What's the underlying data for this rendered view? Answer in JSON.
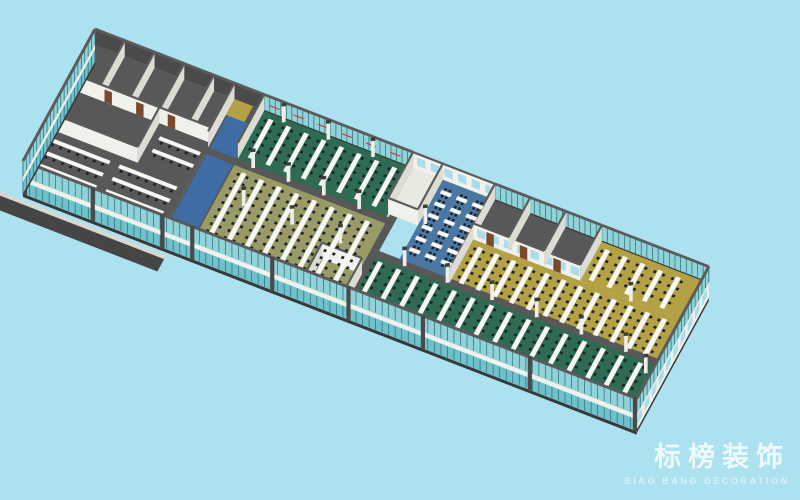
{
  "watermark": {
    "title": "标榜装饰",
    "subtitle": "BIAO BANG DECORATION"
  },
  "colors": {
    "background": "#ace1f0",
    "wall_dark": "#4a4a4a",
    "wall_base": "#383838",
    "wall_cap": "#5b5b5b",
    "wall_white": "#f1f1ec",
    "wall_white_shade": "#dcdcd4",
    "white_floor": "#e9e9e2",
    "glass": "#8fd2d8",
    "glass_dark": "#6fc2cc",
    "mullion": "#2f6e78",
    "window_glass": "#aadcec",
    "floor_dark": "#585858",
    "floor_olive": "#9a9a66",
    "floor_green": "#2e6b52",
    "floor_blue": "#4a78a2",
    "floor_yellow": "#b3a144",
    "carpet_blue": "#3e6da5",
    "desk": "#f6f6f3",
    "chair": "#1a2430",
    "column": "#eeeee8",
    "column_cap": "#3c3c3c",
    "door": "#7b4a2d",
    "signage": "#cc4444",
    "ramp": "#454545",
    "ramp_stripe": "#d8d8d2"
  },
  "scene": {
    "matrix": [
      0.93,
      0.36,
      -0.48,
      0.88,
      95,
      45
    ],
    "story_down": [
      7.75,
      15
    ],
    "ramp": [
      {
        "x": -28,
        "y": 156,
        "w": 185,
        "h": 4,
        "o": 1.05,
        "c": "ramp_stripe",
        "n": "entry-ramp-curb"
      },
      {
        "x": -28,
        "y": 160,
        "w": 185,
        "h": 14,
        "o": 1.05,
        "c": "ramp",
        "n": "entry-ramp"
      }
    ],
    "floors": [
      {
        "n": "meeting-block-floor",
        "x": 0,
        "y": 0,
        "w": 150,
        "h": 150,
        "c": "floor_dark"
      },
      {
        "n": "lobby-floor",
        "x": 150,
        "y": 0,
        "w": 32,
        "h": 150,
        "c": "floor_dark"
      },
      {
        "n": "lobby-carpet",
        "x": 152,
        "y": 18,
        "w": 28,
        "h": 130,
        "c": "carpet_blue"
      },
      {
        "n": "lobby-mat",
        "x": 150,
        "y": 0,
        "w": 20,
        "h": 18,
        "c": "floor_yellow"
      },
      {
        "n": "green-office-back-floor",
        "x": 182,
        "y": 0,
        "w": 160,
        "h": 58,
        "c": "floor_green"
      },
      {
        "n": "olive-office-floor",
        "x": 182,
        "y": 58,
        "w": 168,
        "h": 92,
        "c": "floor_olive"
      },
      {
        "n": "white-room-floor",
        "x": 342,
        "y": 0,
        "w": 32,
        "h": 52,
        "c": "white_floor"
      },
      {
        "n": "pod-zone-floor",
        "x": 374,
        "y": 0,
        "w": 56,
        "h": 95,
        "c": "floor_blue"
      },
      {
        "n": "back-rooms-floor",
        "x": 430,
        "y": 0,
        "w": 115,
        "h": 45,
        "c": "floor_dark"
      },
      {
        "n": "yellow-office-back-floor",
        "x": 545,
        "y": 0,
        "w": 115,
        "h": 45,
        "c": "floor_yellow"
      },
      {
        "n": "yellow-office-floor",
        "x": 430,
        "y": 45,
        "w": 230,
        "h": 50,
        "c": "floor_yellow"
      },
      {
        "n": "green-office-front-floor",
        "x": 350,
        "y": 95,
        "w": 310,
        "h": 55,
        "c": "floor_green"
      },
      {
        "n": "corridor-mid",
        "x": 150,
        "y": 55,
        "w": 200,
        "h": 7,
        "c": "floor_dark"
      },
      {
        "n": "corridor-right",
        "x": 350,
        "y": 90,
        "w": 310,
        "h": 7,
        "c": "floor_dark"
      },
      {
        "n": "corridor-vertical",
        "x": 344,
        "y": 52,
        "w": 8,
        "h": 98,
        "c": "floor_dark"
      }
    ],
    "walls_dark": [
      {
        "x1": 0,
        "y1": 0,
        "x2": 182,
        "y2": 0
      }
    ],
    "glass_back": [
      {
        "x1": 182,
        "y1": 0,
        "x2": 342,
        "y2": 0,
        "signage": true
      },
      {
        "x1": 430,
        "y1": 0,
        "x2": 660,
        "y2": 0
      }
    ],
    "walls_white": [
      {
        "x1": 32,
        "y1": 0,
        "x2": 32,
        "y2": 50
      },
      {
        "x1": 64,
        "y1": 0,
        "x2": 64,
        "y2": 50
      },
      {
        "x1": 96,
        "y1": 0,
        "x2": 96,
        "y2": 50
      },
      {
        "x1": 128,
        "y1": 0,
        "x2": 128,
        "y2": 50
      },
      {
        "x1": 0,
        "y1": 50,
        "x2": 150,
        "y2": 50,
        "doors": [
          40,
          74,
          108
        ]
      },
      {
        "x1": 95,
        "y1": 50,
        "x2": 95,
        "y2": 95
      },
      {
        "x1": 0,
        "y1": 95,
        "x2": 95,
        "y2": 95
      },
      {
        "x1": 150,
        "y1": 0,
        "x2": 150,
        "y2": 55
      },
      {
        "x1": 182,
        "y1": 0,
        "x2": 182,
        "y2": 55
      },
      {
        "x1": 342,
        "y1": 0,
        "x2": 430,
        "y2": 0,
        "windows": true
      },
      {
        "x1": 342,
        "y1": 0,
        "x2": 342,
        "y2": 52
      },
      {
        "x1": 374,
        "y1": 0,
        "x2": 374,
        "y2": 52
      },
      {
        "x1": 342,
        "y1": 52,
        "x2": 374,
        "y2": 52
      },
      {
        "x1": 430,
        "y1": 0,
        "x2": 430,
        "y2": 95
      },
      {
        "x1": 430,
        "y1": 45,
        "x2": 545,
        "y2": 45,
        "doors": [
          448,
          484,
          520
        ],
        "windows": true
      },
      {
        "x1": 468,
        "y1": 0,
        "x2": 468,
        "y2": 45
      },
      {
        "x1": 506,
        "y1": 0,
        "x2": 506,
        "y2": 45
      },
      {
        "x1": 545,
        "y1": 0,
        "x2": 545,
        "y2": 45
      },
      {
        "x1": 305,
        "y1": 118,
        "x2": 348,
        "y2": 118
      },
      {
        "x1": 305,
        "y1": 118,
        "x2": 305,
        "y2": 149
      },
      {
        "x1": 348,
        "y1": 118,
        "x2": 348,
        "y2": 149
      }
    ],
    "desk_groups": [
      {
        "name": "green-back-desks",
        "x0": 190,
        "step": 19,
        "count": 8,
        "y0": 6,
        "len": 44
      },
      {
        "name": "olive-desks",
        "x0": 192,
        "step": 19,
        "count": 8,
        "y0": 66,
        "len": 78
      },
      {
        "name": "yellow-mid-desks",
        "x0": 438,
        "step": 18,
        "count": 12,
        "y0": 50,
        "len": 41
      },
      {
        "name": "yellow-back-desks",
        "x0": 552,
        "step": 19,
        "count": 5,
        "y0": 6,
        "len": 35
      },
      {
        "name": "green-front-desks",
        "x0": 356,
        "step": 20,
        "count": 15,
        "y0": 100,
        "len": 46
      }
    ],
    "benches": [
      {
        "x": 6,
        "y": 103,
        "w": 64
      },
      {
        "x": 6,
        "y": 117,
        "w": 64
      },
      {
        "x": 6,
        "y": 131,
        "w": 64
      },
      {
        "x": 80,
        "y": 103,
        "w": 62
      },
      {
        "x": 80,
        "y": 117,
        "w": 62
      },
      {
        "x": 80,
        "y": 131,
        "w": 62
      },
      {
        "x": 102,
        "y": 62,
        "w": 44
      },
      {
        "x": 102,
        "y": 76,
        "w": 44
      }
    ],
    "pods": {
      "x0": 378,
      "y0": 10,
      "cols": 3,
      "rows": 6,
      "dx": 17,
      "dy": 13,
      "dw": 11,
      "dh": 4
    },
    "columns": [
      [
        200,
        58
      ],
      [
        238,
        58
      ],
      [
        276,
        58
      ],
      [
        314,
        58
      ],
      [
        205,
        4
      ],
      [
        253,
        4
      ],
      [
        301,
        4
      ],
      [
        210,
        97
      ],
      [
        262,
        97
      ],
      [
        314,
        97
      ],
      [
        382,
        95
      ],
      [
        428,
        95
      ],
      [
        476,
        95
      ],
      [
        524,
        95
      ],
      [
        572,
        95
      ],
      [
        620,
        95
      ],
      [
        380,
        48
      ],
      [
        600,
        46
      ],
      [
        648,
        108
      ]
    ],
    "front_facade": {
      "x1": 0,
      "y1": 150,
      "x2": 660,
      "y2": 150,
      "pillars": [
        2,
        75,
        150,
        182,
        268,
        350,
        430,
        545,
        658
      ]
    },
    "left_end": {
      "x1": 0,
      "y1": 0,
      "x2": 0,
      "y2": 150
    },
    "right_end": {
      "x1": 660,
      "y1": 0,
      "x2": 660,
      "y2": 150
    }
  }
}
